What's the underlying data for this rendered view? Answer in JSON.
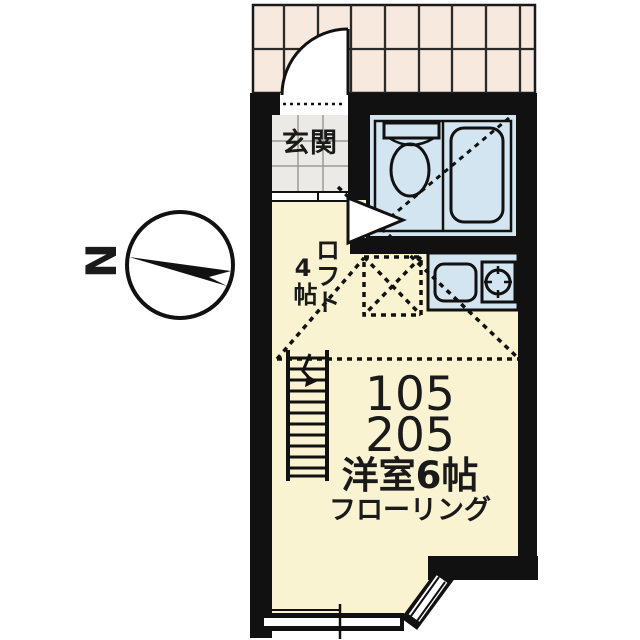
{
  "labels": {
    "entrance": "玄関",
    "loft_name": "ロフト",
    "loft_size": "4帖",
    "unit_number_1": "105",
    "unit_number_2": "205",
    "room_name": "洋室6帖",
    "room_finish": "フローリング",
    "north": "N"
  },
  "colors": {
    "background": "#ffffff",
    "wall": "#111111",
    "room_floor": "#faf3d1",
    "wet_area": "#d3e5f1",
    "porch_tile": "#f7e9dd",
    "entrance_tile": "#ebeae6"
  }
}
